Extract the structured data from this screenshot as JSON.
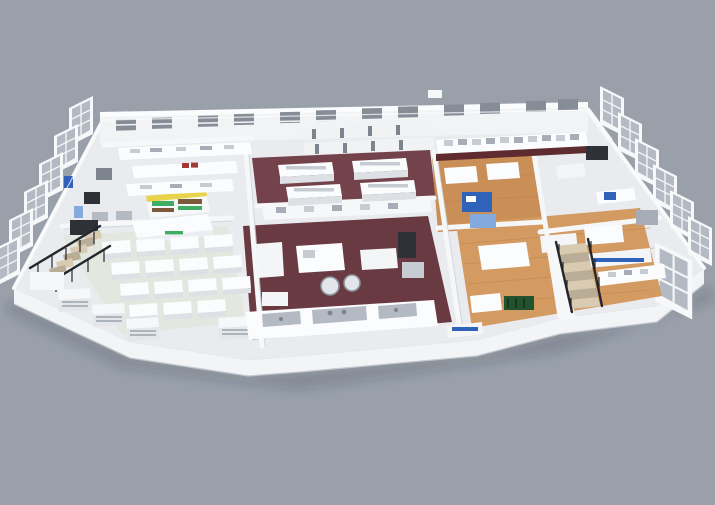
{
  "scene": {
    "background_color": "#99A0AA",
    "shadow_color": "rgba(40,45,55,0.18)"
  },
  "palette": {
    "wall_bright": "#fbfcfd",
    "wall_face": "#f2f3f5",
    "floor_default": "#e9ebee",
    "floor_maroon_upper": "#74424a",
    "floor_maroon_lower": "#693a41",
    "floor_wood": "#c98f57",
    "floor_wood_light": "#d39a61",
    "floor_mint": "#e3e7e0",
    "window_glass": "#b3bac3",
    "window_dark": "#868d97",
    "accent_blue": "#2f62b8",
    "accent_blue_light": "#84a9dc",
    "accent_yellow": "#e8d34b",
    "accent_green": "#3fae62",
    "accent_green_dark": "#24512e",
    "accent_red": "#a23a35",
    "bench_kick_darkred": "#5e2b2e",
    "stair_tan": "#d8cbb2",
    "stair_riser": "#b9ad97",
    "dark_equipment": "#2e3237"
  }
}
